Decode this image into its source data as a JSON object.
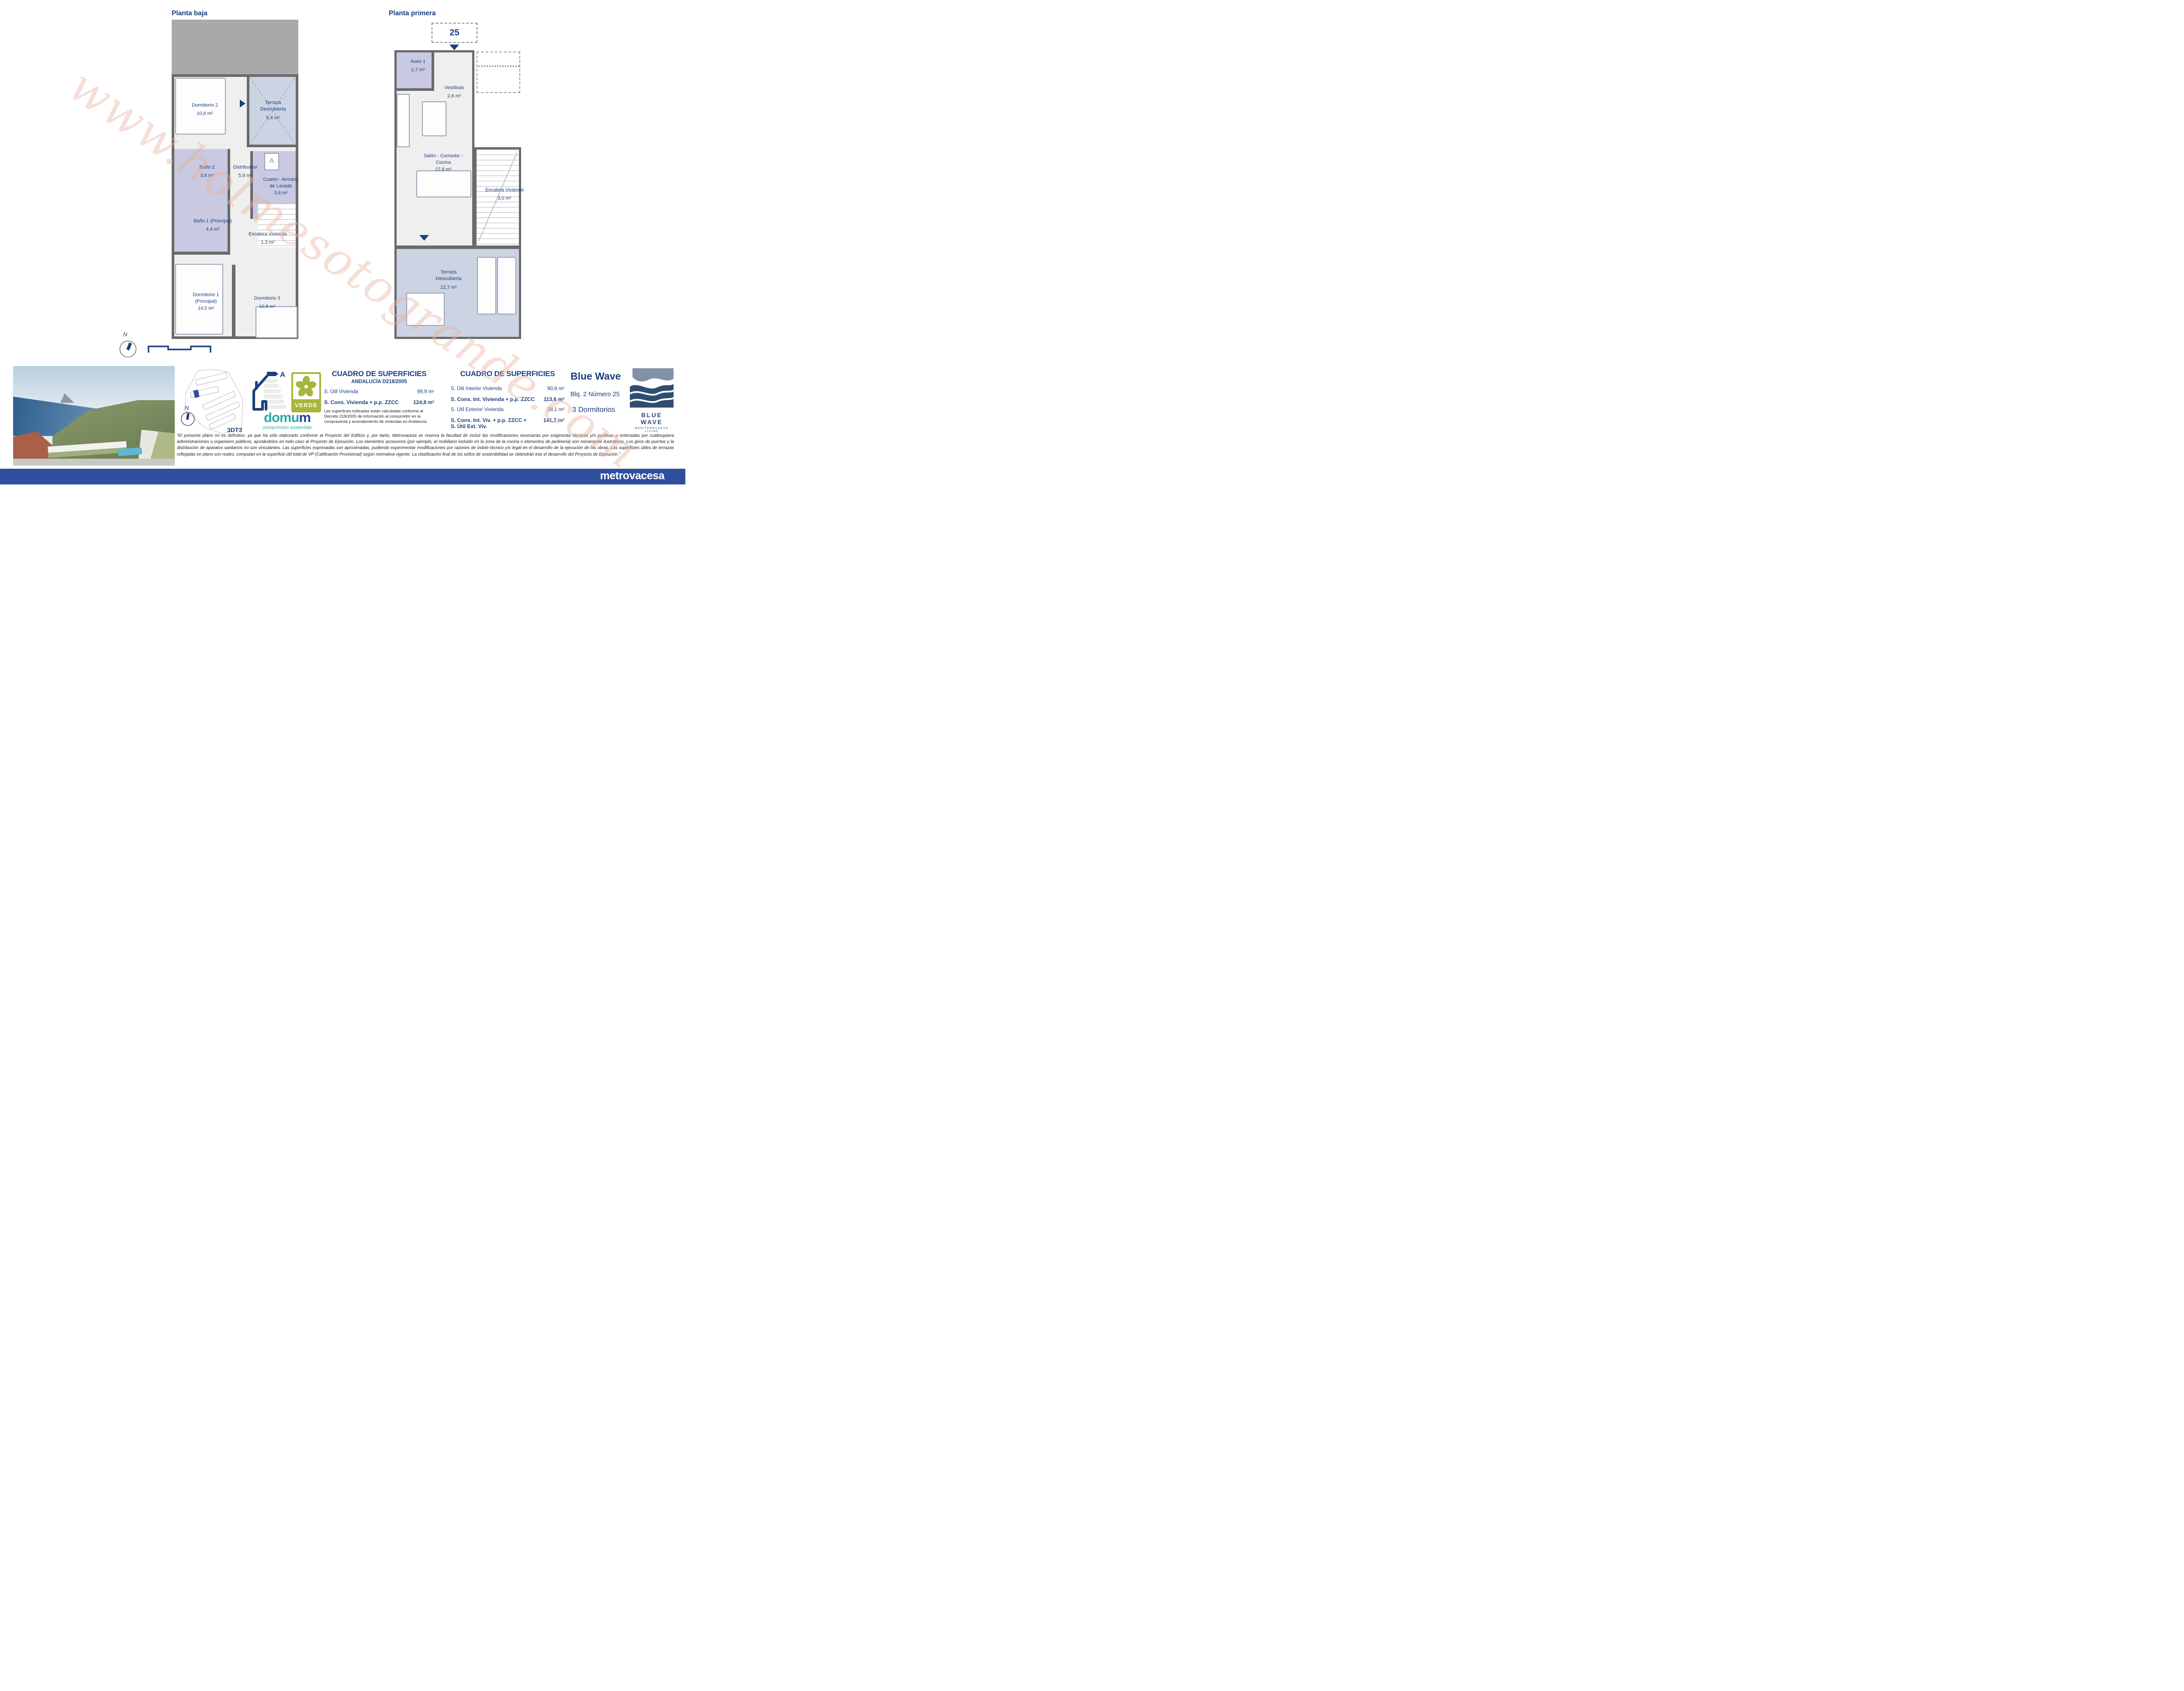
{
  "watermark": "www.holmesotogrande.com",
  "planta_baja": {
    "title": "Planta baja",
    "compass_label": "N",
    "rooms": {
      "dormitorio2": {
        "name": "Dormitorio 2",
        "area": "10,6 m²"
      },
      "terraza": {
        "line1": "Terraza",
        "line2": "Descubierta",
        "area": "5,4 m²"
      },
      "bano2": {
        "name": "Baño 2",
        "area": "3,6 m²"
      },
      "distribuidor": {
        "name": "Distribuidor",
        "area": "5,9 m²"
      },
      "cuarto": {
        "line1": "Cuarto - Armario",
        "line2": "de Lavado",
        "area": "3,8 m²"
      },
      "bano1": {
        "name": "Baño 1 (Principal)",
        "area": "4,4 m²"
      },
      "escalera": {
        "name": "Escalera Vivienda",
        "area": "1,3 m²"
      },
      "dormitorio1": {
        "line1": "Dormitorio 1",
        "line2": "(Principal)",
        "area": "14,5 m²"
      },
      "dormitorio3": {
        "name": "Dormitorio 3",
        "area": "10,8 m²"
      }
    }
  },
  "planta_primera": {
    "title": "Planta primera",
    "unit_number": "25",
    "rooms": {
      "aseo1": {
        "name": "Aseo 1",
        "area": "2,7 m²"
      },
      "vestibulo": {
        "name": "Vestíbulo",
        "area": "2,6 m²"
      },
      "salon": {
        "line1": "Salón - Comedor -",
        "line2": "Cocina",
        "area": "27,6 m²"
      },
      "escalera": {
        "name": "Escalera Vivienda",
        "area": "3,0 m²"
      },
      "terraza": {
        "line1": "Terraza",
        "line2": "Descubierta",
        "area": "22,7 m²"
      }
    }
  },
  "site_plan": {
    "label": "3DT3",
    "compass_label": "N"
  },
  "energy": {
    "rating": "A"
  },
  "verde": {
    "label": "VERDE"
  },
  "domum": {
    "name_teal": "domu",
    "name_blue": "m",
    "tagline": "compromiso sostenible"
  },
  "cuadro_left": {
    "title": "CUADRO DE SUPERFICIES",
    "subtitle": "ANDALUCÍA D218/2005",
    "rows": [
      {
        "label": "S. Útil Vivienda",
        "value": "99,9 m²"
      },
      {
        "label": "S. Cons. Vivienda + p.p. ZZCC",
        "value": "124,8 m²"
      }
    ],
    "note": "Las superficies indicadas están calculadas conforme al Decreto 218/2005 de información al consumidor en la compraventa y arrendamiento de viviendas en Andalucía."
  },
  "cuadro_right": {
    "title": "CUADRO DE SUPERFICIES",
    "rows": [
      {
        "label": "S. Útil Interior Vivienda",
        "value": "90,8 m²"
      },
      {
        "label": "S. Cons. Int. Vivienda + p.p. ZZCC",
        "value": "113,6 m²"
      },
      {
        "label": "S. Útil Exterior Vivienda",
        "value": "28,1 m²"
      },
      {
        "label": "S. Cons. Int. Viv. + p.p. ZZCC + S. Útil Ext. Viv.",
        "value": "141,7 m²"
      }
    ]
  },
  "unit_info": {
    "project": "Blue Wave",
    "block": "Blq. 2 Número 25",
    "bedrooms": "3 Dormitorios"
  },
  "brand_logo": {
    "name": "BLUE WAVE",
    "tagline": "MEDITERRANEAN LIVING"
  },
  "disclaimer": "“El presente plano no es definitivo, ya que ha sido elaborado conforme al Proyecto del Edificio y, por tanto, Metrovacesa se reserva la facultad de incluir las modificaciones necesarias por exigencias técnicas y/o jurídicas u ordenadas por cualesquiera administraciones u organismo públicos, ajustándolos en todo caso al Proyecto de Ejecución. Los elementos accesorios (por ejemplo, el mobiliario incluido en la zona de la cocina o elementos de jardineria) son meramente ilustrativos. Los giros de puertas y la distribución de aparatos sanitarios no son vinculantes. Las superficies expresadas son aproximadas, pudiendo experimentar modificaciones por razones de indole técnico y/o legal en el desarrollo de la ejecución de las obras. Las superficies útiles de terrazas reflejadas en plano son reales, computan en la superficie útil total de VP (Calificación Provisional) según normativa vigente. La clasificación final de los sellos de sostenibilidad se obtendrán tras el desarrollo del Proyecto de Ejecución.”",
  "footer": {
    "brand": "metrovacesa"
  },
  "colors": {
    "navy": "#1b3f7e",
    "footer_blue": "#2e4f9d",
    "wall_gray": "#6a6a6a",
    "wet_room": "#c9c9e1",
    "terrace": "#ccd3e2",
    "verde_green": "#a7b53b",
    "domum_teal": "#2fa9a4",
    "watermark_pink": "#e7b29e",
    "logo_slate": "#8092a8",
    "logo_navy": "#2f4d6e"
  }
}
